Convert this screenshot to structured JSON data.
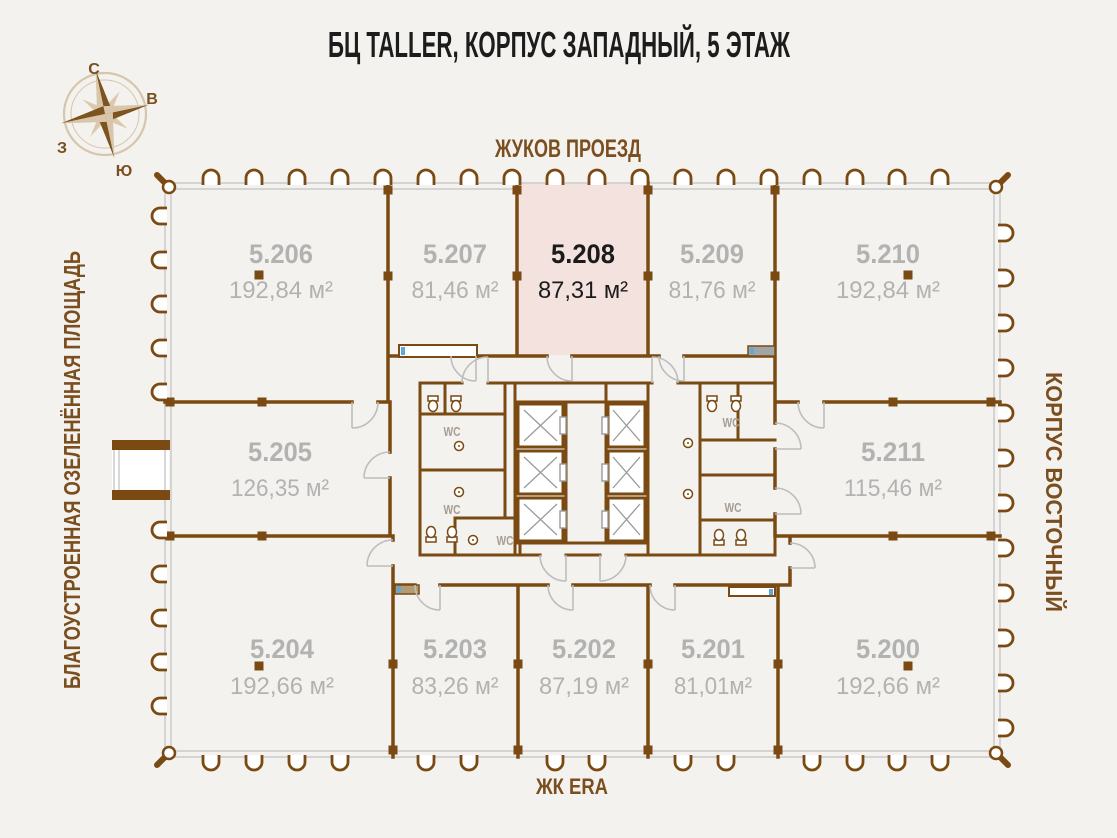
{
  "title": "БЦ TALLER, КОРПУС ЗАПАДНЫЙ, 5 ЭТАЖ",
  "surroundings": {
    "top": "ЖУКОВ ПРОЕЗД",
    "bottom": "ЖК ERA",
    "left": "БЛАГОУСТРОЕННАЯ ОЗЕЛЕНЁННАЯ ПЛОЩАДЬ",
    "right": "КОРПУС ВОСТОЧНЫЙ"
  },
  "compass": {
    "north": "С",
    "east": "В",
    "south": "Ю",
    "west": "З"
  },
  "core": {
    "wc_label": "WC"
  },
  "rooms": [
    {
      "number": "5.206",
      "area": "192,84 м²",
      "highlighted": false
    },
    {
      "number": "5.207",
      "area": "81,46 м²",
      "highlighted": false
    },
    {
      "number": "5.208",
      "area": "87,31 м²",
      "highlighted": true
    },
    {
      "number": "5.209",
      "area": "81,76 м²",
      "highlighted": false
    },
    {
      "number": "5.210",
      "area": "192,84 м²",
      "highlighted": false
    },
    {
      "number": "5.205",
      "area": "126,35 м²",
      "highlighted": false
    },
    {
      "number": "5.211",
      "area": "115,46 м²",
      "highlighted": false
    },
    {
      "number": "5.204",
      "area": "192,66 м²",
      "highlighted": false
    },
    {
      "number": "5.203",
      "area": "83,26 м²",
      "highlighted": false
    },
    {
      "number": "5.202",
      "area": "87,19 м²",
      "highlighted": false
    },
    {
      "number": "5.201",
      "area": "81,01м²",
      "highlighted": false
    },
    {
      "number": "5.200",
      "area": "192,66 м²",
      "highlighted": false
    }
  ],
  "colors": {
    "wall": "#7a4a12",
    "highlight_fill": "#f3e2de",
    "label_gray": "#b2b2b2",
    "brown_text": "#7a4e1e",
    "dark_text": "#1b1b1b",
    "background": "#f3f2ef"
  }
}
